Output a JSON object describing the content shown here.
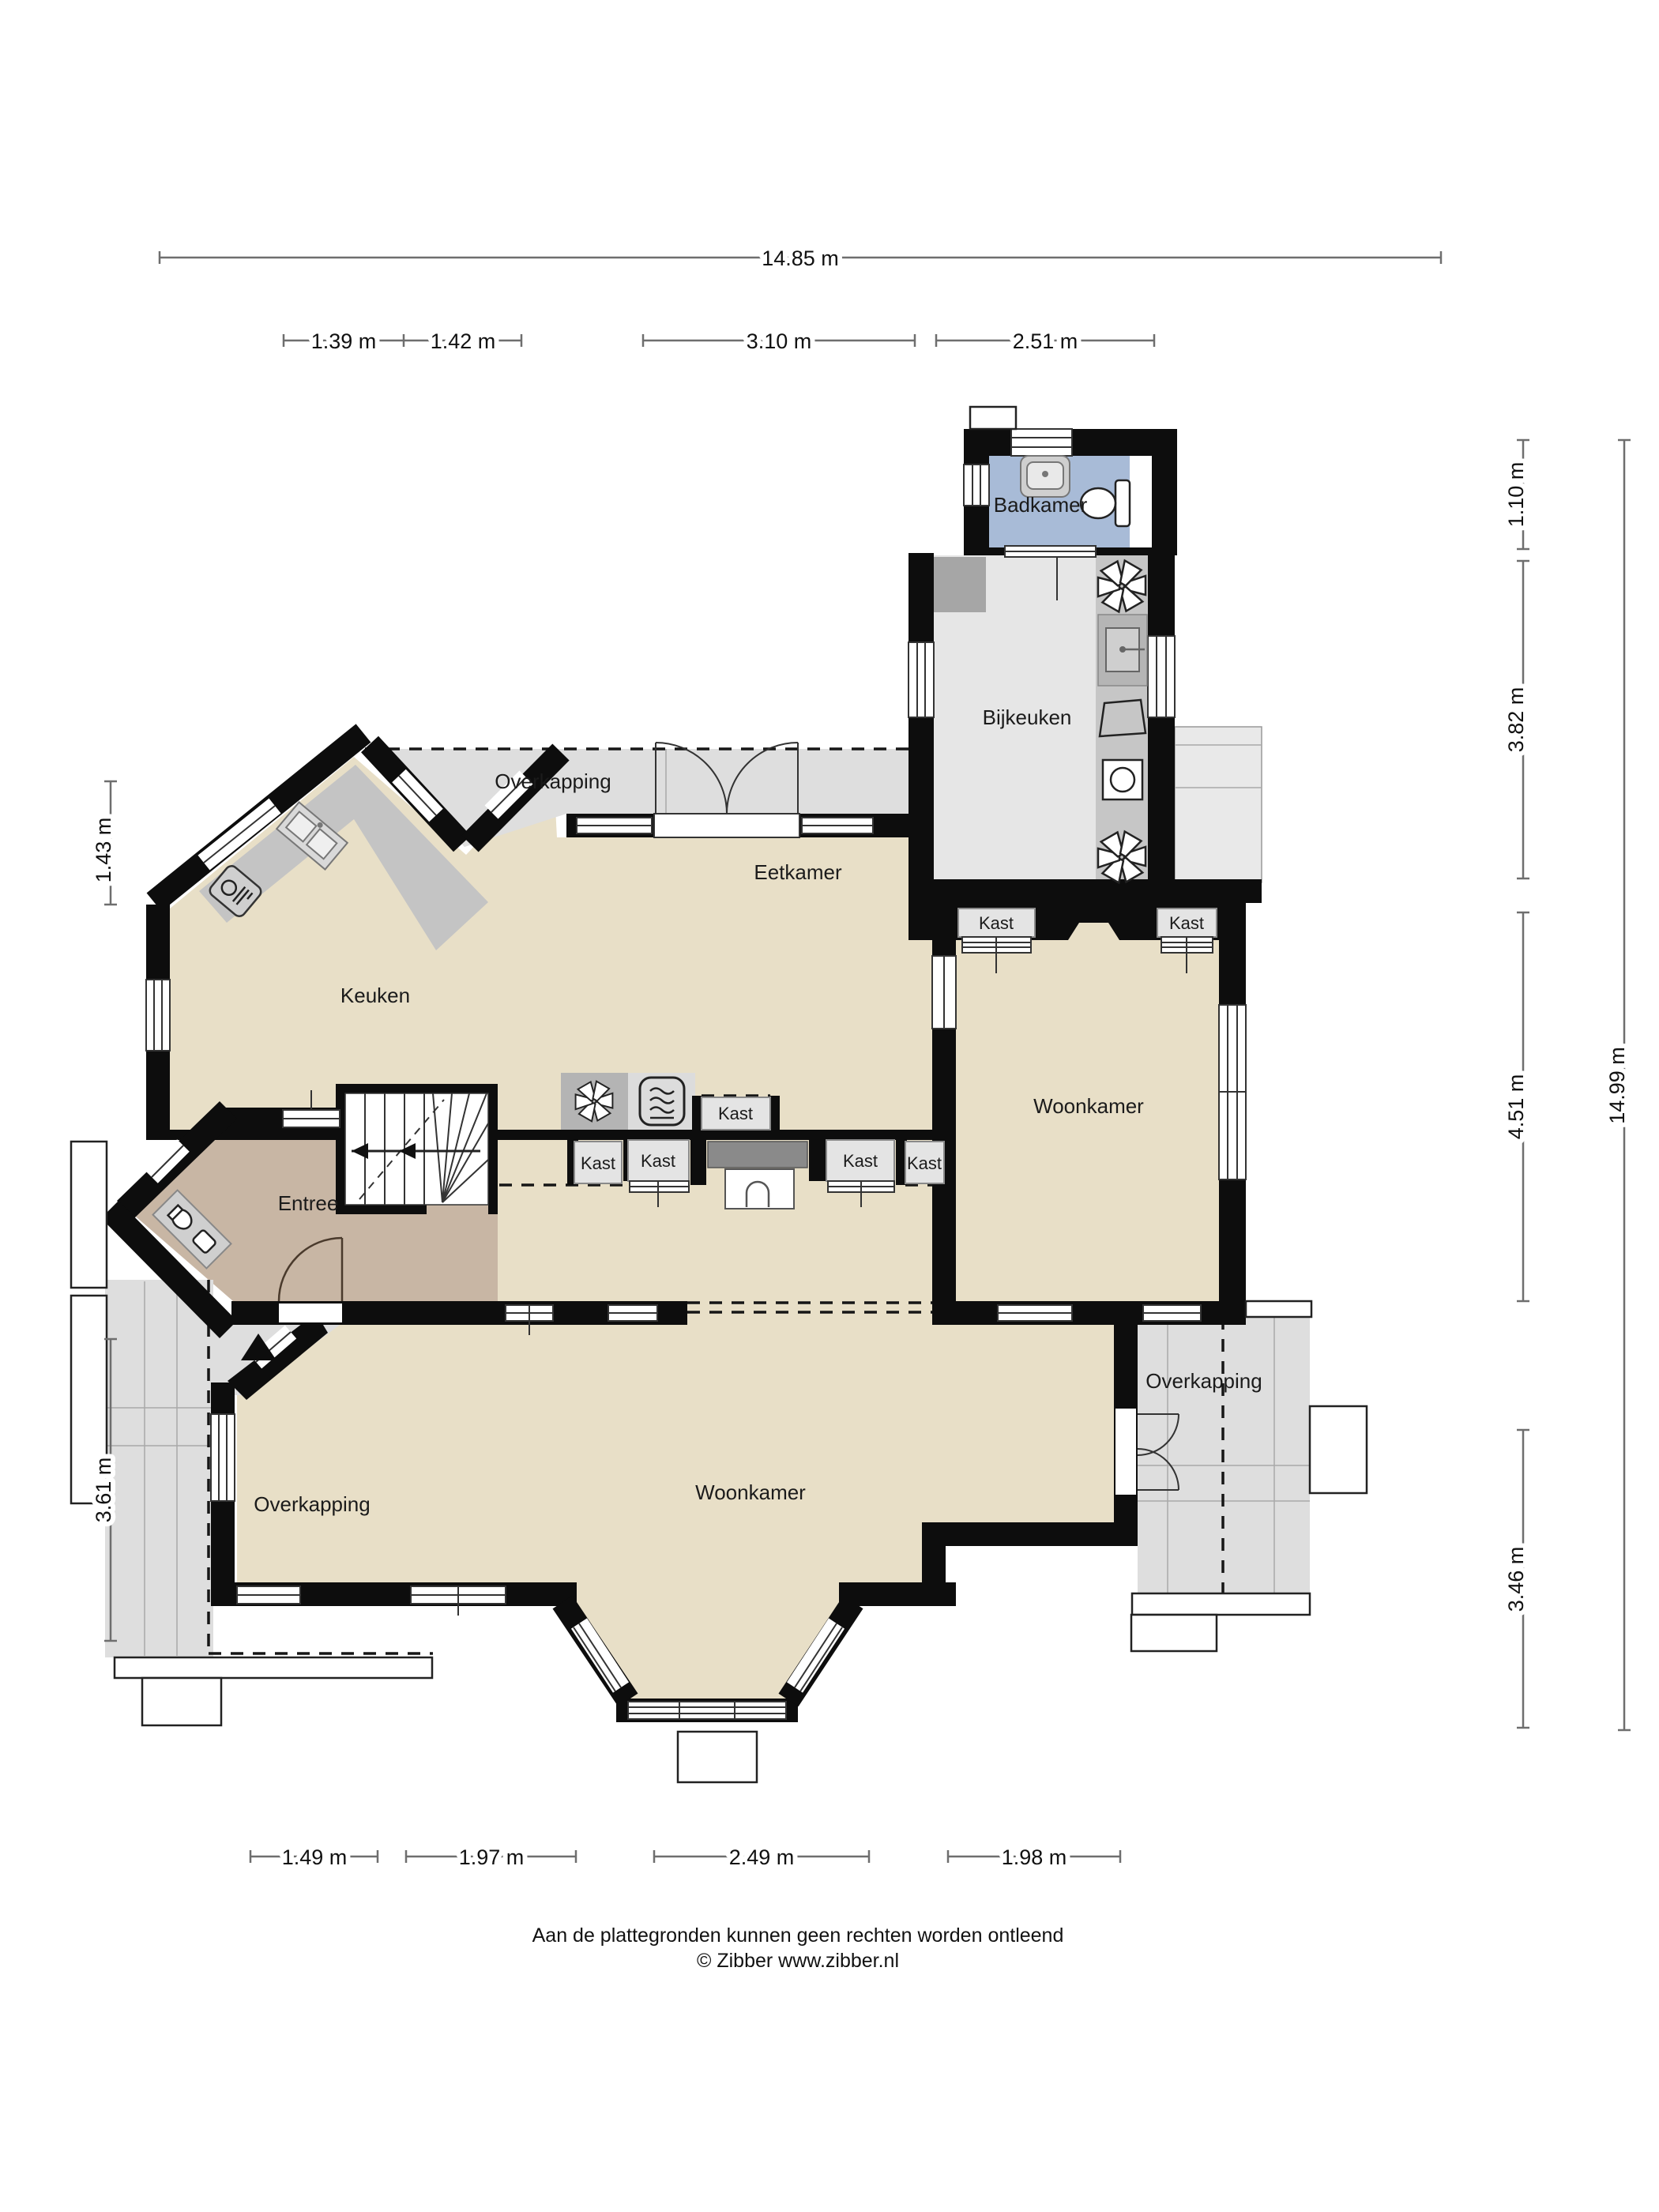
{
  "rooms": {
    "badkamer": "Badkamer",
    "bijkeuken": "Bijkeuken",
    "eetkamer": "Eetkamer",
    "keuken": "Keuken",
    "entree": "Entree",
    "woonkamer_top": "Woonkamer",
    "woonkamer_bottom": "Woonkamer",
    "overkapping_top": "Overkapping",
    "overkapping_left": "Overkapping",
    "overkapping_right": "Overkapping"
  },
  "labels": {
    "kast": "Kast"
  },
  "dimensions": {
    "top_total": "14.85 m",
    "row2": [
      "1.39 m",
      "1.42 m",
      "3.10 m",
      "2.51 m"
    ],
    "left": [
      "1.43 m",
      "3.61 m"
    ],
    "right": [
      "1.10 m",
      "3.82 m",
      "4.51 m",
      "3.46 m"
    ],
    "right_total": "14.99 m",
    "bottom": [
      "1.49 m",
      "1.97 m",
      "2.49 m",
      "1.98 m"
    ]
  },
  "footer": {
    "line1": "Aan de plattegronden kunnen geen rechten worden ontleend",
    "line2": "© Zibber www.zibber.nl"
  },
  "icons": [
    "fan-icon",
    "oven-icon",
    "sink-icon",
    "toilet-icon",
    "washing-machine-icon",
    "laundry-basket-icon",
    "dishwasher-icon",
    "fireplace-icon",
    "north-arrow-icon",
    "stairs-icon"
  ],
  "colors": {
    "wall": "#0d0d0d",
    "floor_living": "#e8dfc7",
    "floor_entree": "#c8b6a4",
    "floor_bath": "#a8bbd7",
    "floor_utility": "#e6e6e6",
    "counter": "#c6c6c6",
    "overkapping": "#dedede"
  }
}
